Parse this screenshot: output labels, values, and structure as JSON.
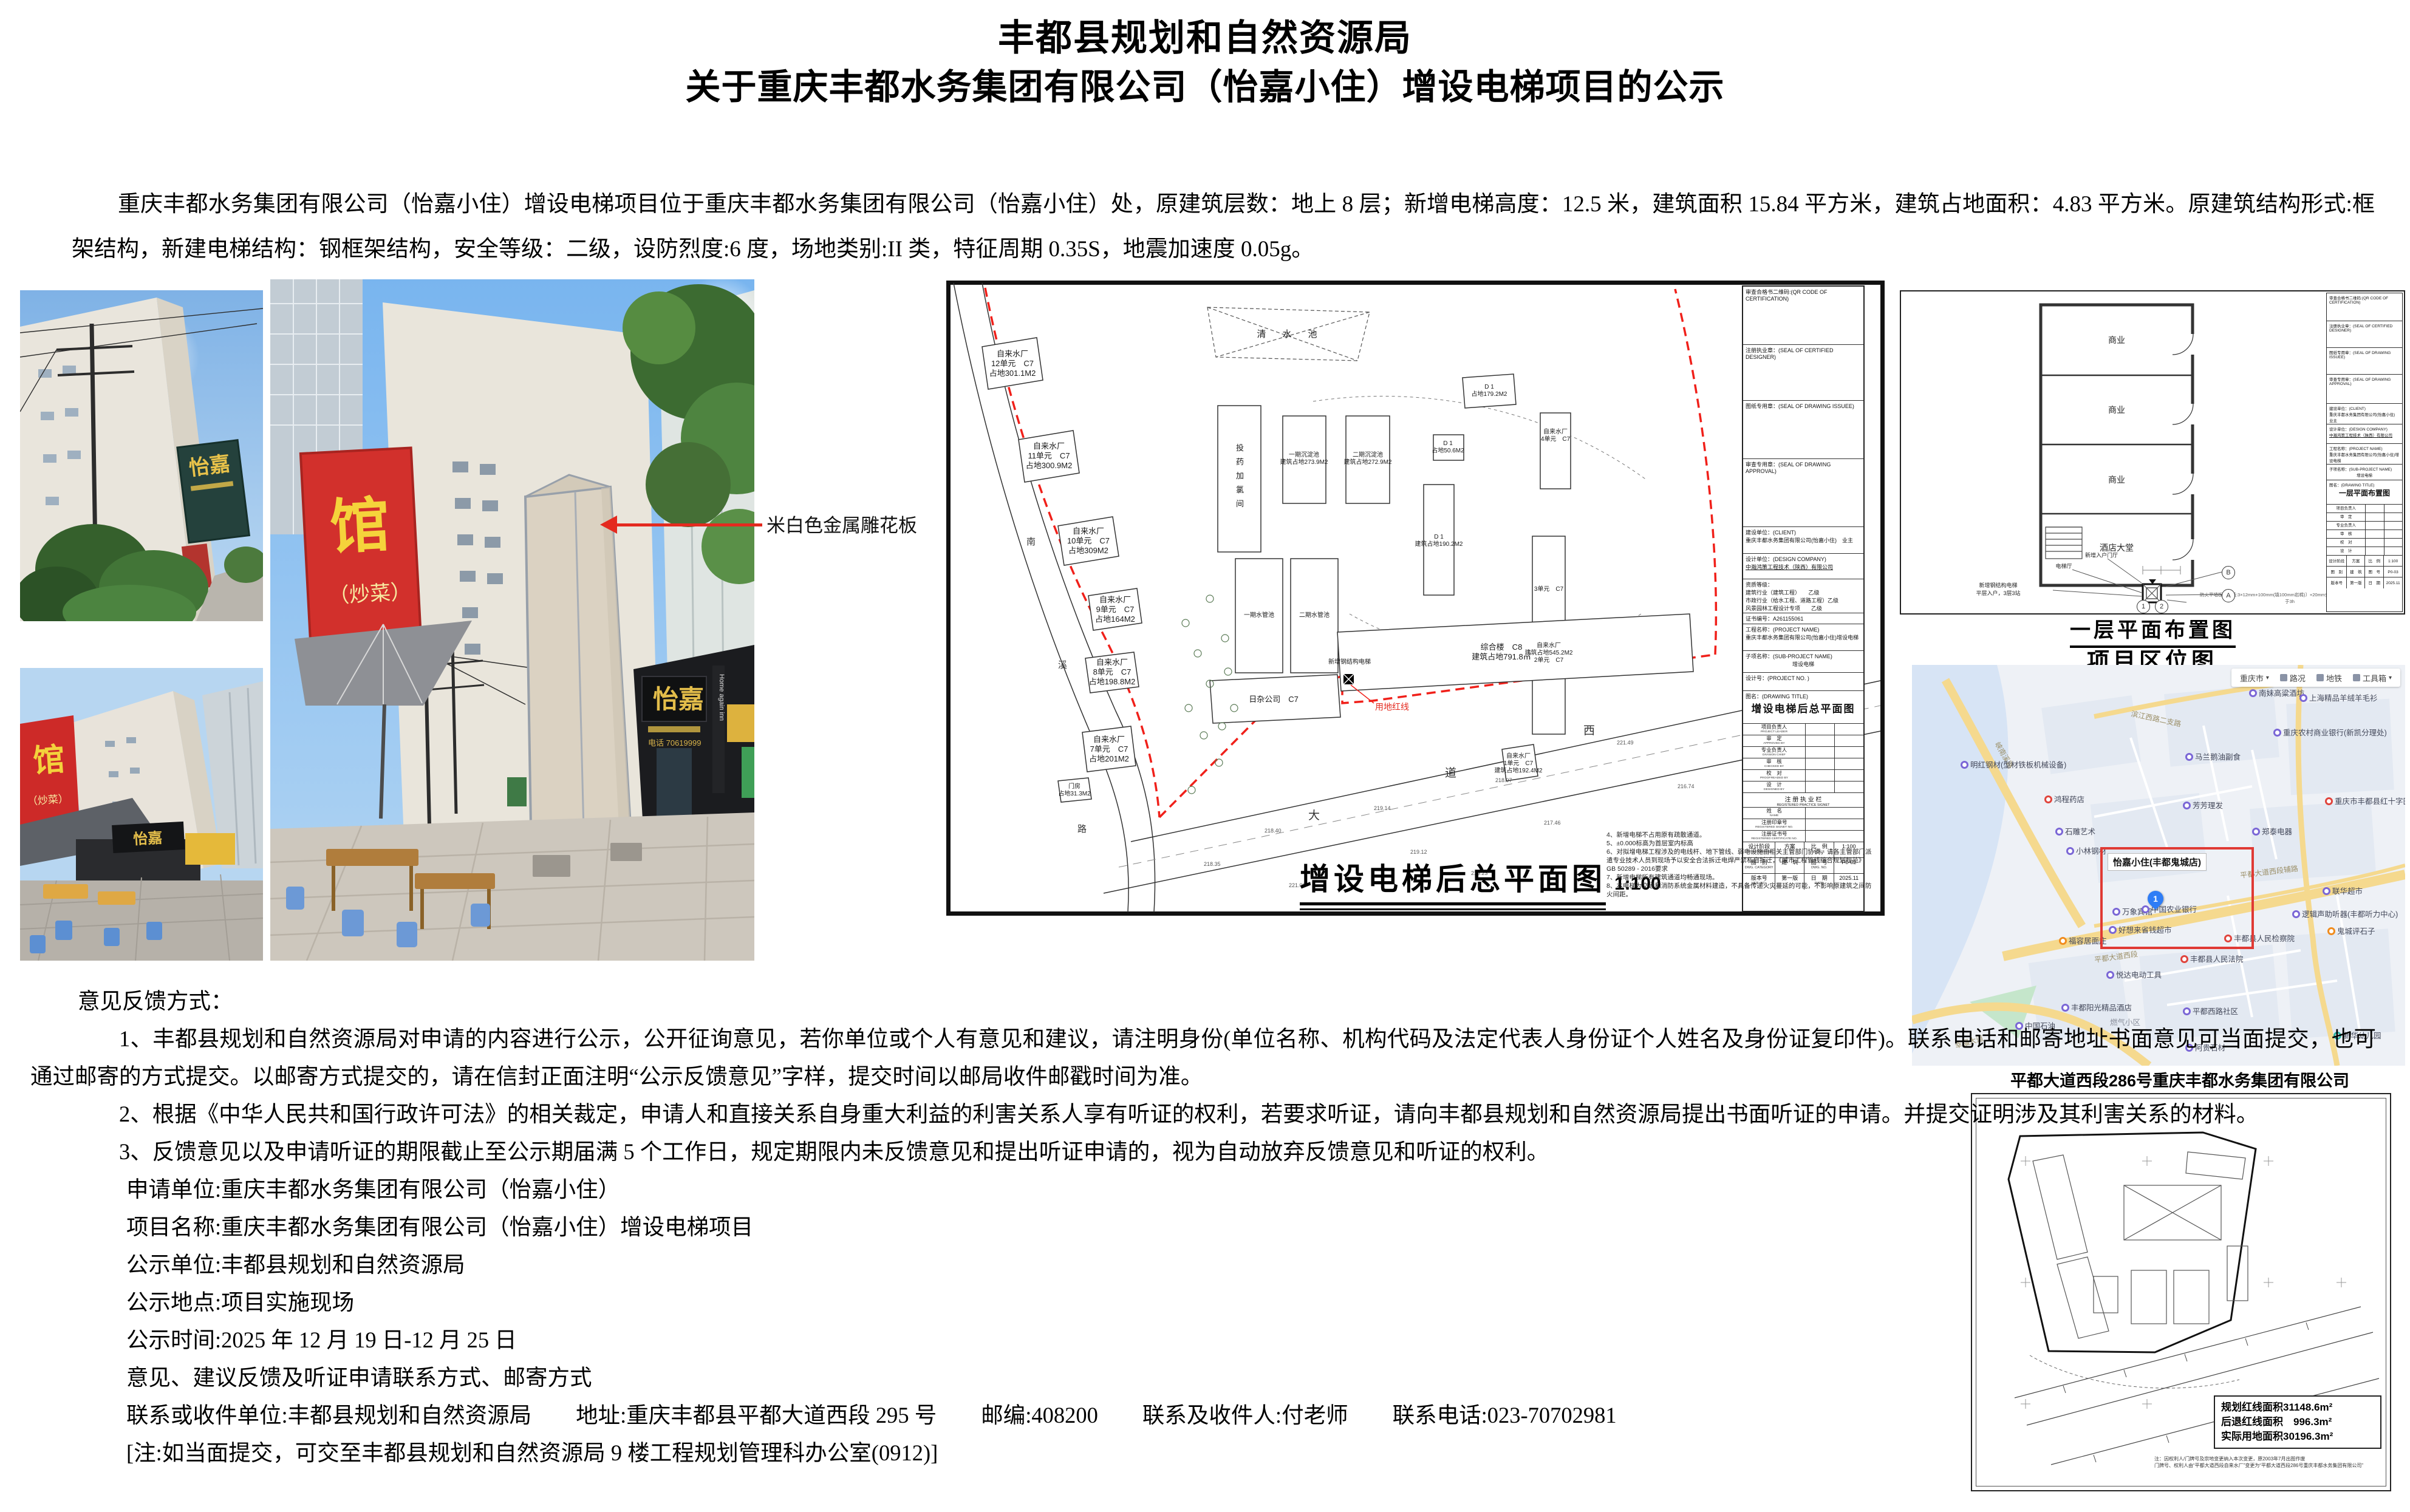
{
  "header": {
    "title": "丰都县规划和自然资源局",
    "subtitle": "关于重庆丰都水务集团有限公司（怡嘉小住）增设电梯项目的公示"
  },
  "intro": {
    "text": "重庆丰都水务集团有限公司（怡嘉小住）增设电梯项目位于重庆丰都水务集团有限公司（怡嘉小住）处，原建筑层数：地上 8 层；新增电梯高度：12.5 米，建筑面积 15.84 平方米，建筑占地面积：4.83 平方米。原建筑结构形式:框架结构，新建电梯结构：钢框架结构，安全等级：二级，设防烈度:6 度，场地类别:II 类，特征周期 0.35S，地震加速度 0.05g。"
  },
  "annotation": {
    "label": "米白色金属雕花板"
  },
  "photos": {
    "sign_yijia": "怡嘉",
    "sign_phone": "电话 70619999",
    "sign_home": "Home again inn",
    "banner_hall": "馆",
    "banner_dish": "（炒菜）"
  },
  "master_plan": {
    "caption": "增设电梯后总平面图",
    "scale": "1:100",
    "red_line_label": "用地红线",
    "elevator_label": "新增钢结构电梯",
    "road_chars": [
      "大",
      "道",
      "西"
    ],
    "river_chars": [
      "南",
      "溪",
      "路"
    ],
    "spot_elevations": [
      "218.40",
      "219.14",
      "218.97",
      "221.49",
      "218.35",
      "219.12",
      "217.46",
      "216.74",
      "221.06",
      "219.23"
    ],
    "notes": [
      "4、新增电梯不占用原有疏散通道。",
      "5、±0.000标高为首层室内标高",
      "6、对拟增电梯工程涉及的电线杆、地下管线、弱电设施由相关主管部门协调，请各主管部门派遣专业技术人员到现场予以安全合法拆迁电焊严禁私自拆迁，《城市工程管线综合规划规范》GB 50289 - 2016要求",
      "7、新增电梯所有建筑通道均畅通现场。",
      "8、本电梯为交通和消防系统金属材料建造，不具备传递火灾蔓延的可能，不影响原建筑之间防火间距。"
    ],
    "labels": {
      "csc": "清　水　池",
      "tyjlj": "投药加氯间",
      "cdc1": [
        "一期沉淀池",
        "建筑占地273.9M2"
      ],
      "cdc2": [
        "二期沉淀池",
        "建筑占地272.9M2"
      ],
      "sgc1": "一期水管池",
      "sgc2": "二期水管池",
      "u12": [
        "自来水厂",
        "12单元　C7",
        "占地301.1M2"
      ],
      "u11": [
        "自来水厂",
        "11单元　C7",
        "占地300.9M2"
      ],
      "u10": [
        "自来水厂",
        "10单元　C7",
        "占地309M2"
      ],
      "u9": [
        "自来水厂",
        "9单元　C7",
        "占地164M2"
      ],
      "u8": [
        "自来水厂",
        "8单元　C7",
        "占地198.8M2"
      ],
      "u7": [
        "自来水厂",
        "7单元　C7",
        "占地201M2"
      ],
      "mf": [
        "门房",
        "占地31.3M2"
      ],
      "d1a": [
        "D 1",
        "占地179.2M2"
      ],
      "d1b": [
        "D 1",
        "占地50.6M2"
      ],
      "d1c": [
        "D 1",
        "建筑占地190.2M2"
      ],
      "u4": [
        "自来水厂",
        "4单元　C7"
      ],
      "u3": [
        "3单元　C7"
      ],
      "u2": [
        "自来水厂",
        "建筑占地545.2M2",
        "2单元　C7"
      ],
      "u1": [
        "自来水厂",
        "1单元　C7",
        "建筑占地192.4M2"
      ],
      "zhl": [
        "综合楼　C8",
        "建筑占地791.8㎡"
      ],
      "rz": [
        "日杂公司　C7"
      ]
    },
    "title_block": {
      "qr": "审查合格书二维码:(QR CODE OF CERTIFICATION)",
      "seal1": "注册执业章：(SEAL OF CERTIFIED DESIGNER)",
      "seal2": "图纸专用章：(SEAL OF DRAWING ISSUEE)",
      "seal3": "审查专用章：(SEAL OF DRAWING APPROVAL)",
      "client_label": "建设单位：(CLIENT)",
      "client": "重庆丰都水务集团有限公司(怡嘉小住)　业主",
      "designer_label": "设计单位：(DESIGN COMPANY)",
      "designer": "中瀚鸿策工程技术（陕西）有限公司",
      "quals_label": "资质等级：",
      "qual1": "建筑行业（建筑工程）　　乙级",
      "qual2": "市政行业（给水工程、道路工程）乙级",
      "qual3": "风景园林工程设计专项　　乙级",
      "cert_no": "证书编号：A261155061",
      "project_label": "工程名称：(PROJECT NAME)",
      "project": "重庆丰都水务集团有限公司(怡嘉小住)增设电梯",
      "sub_label": "子项名称：(SUB-PROJECT NAME)",
      "sub": "增设电梯",
      "design_no_label": "设计号：(PROJECT NO. )",
      "dwg_title_label": "图名：(DRAWING TITLE)",
      "dwg_title": "增设电梯后总平面图",
      "sig_rows": [
        [
          "项目负责人",
          "PROJECT LEADER"
        ],
        [
          "审　定",
          "APPROVED BY"
        ],
        [
          "专业负责人",
          "DIVISION CHIEF"
        ],
        [
          "审　核",
          "CHECKED BY"
        ],
        [
          "校　对",
          "PROOFREADED BY"
        ],
        [
          "设　计",
          "DESIGNED BY"
        ]
      ],
      "practice_bar": "注 册 执 业 栏",
      "practice_bar_en": "REGISTERED PRACTICE SIGNET",
      "name_rows": [
        [
          "姓　名",
          "NAME"
        ],
        [
          "注册印章号",
          "REGISTERED SIGNET NO."
        ],
        [
          "注册证书号",
          "REGISTERED CERTIFICATE NO."
        ]
      ],
      "grid": [
        [
          "设计阶段",
          "方案",
          "比　例",
          "1:100"
        ],
        [
          "图　别",
          "建　筑",
          "图　号",
          "P0-02"
        ],
        [
          "版本号",
          "第一版",
          "日　期",
          "2025.11"
        ]
      ],
      "grid_en": [
        "DESIGN PHASE",
        "SCALE",
        "DWG. CATEGORY",
        "DWG. NO.",
        "VER. NO.",
        "DATE"
      ]
    }
  },
  "floor_plan": {
    "rooms": [
      "商业",
      "商业",
      "商业",
      "酒店大堂"
    ],
    "lobby_label": "新增入户门厅",
    "hall_label": "电梯厅",
    "elevator_label": "新增钢结构电梯",
    "elevator_label2": "平层入户，3层3站",
    "fire_note": "防火平墙板〔构造:3×12mm+100mm(填100mm岩棉)〕+20mm金属雕花板，耐火极限不低于3h",
    "caption1": "一层平面布置图",
    "caption2": "项目区位图",
    "tb": {
      "dwg_title": "一层平面布置图",
      "phase": "方案",
      "scale": "1:100",
      "cat": "建　筑",
      "dwg_no": "P0-03",
      "ver": "第一版",
      "date": "2025.11"
    }
  },
  "map": {
    "controls": [
      "重庆市",
      "路况",
      "地铁",
      "工具箱"
    ],
    "highlight": {
      "name": "怡嘉小住(丰都鬼城店)",
      "marker": "1"
    },
    "roads": [
      "平都大道西段",
      "平都大道西段辅路",
      "幸福大道",
      "滨江西路二支路",
      "峡南溪路"
    ],
    "pois": [
      {
        "name": "南妹高粱酒坊",
        "type": "purple"
      },
      {
        "name": "上海精品羊绒羊毛衫",
        "type": "purple"
      },
      {
        "name": "重庆农村商业银行(新凯分理处)",
        "type": "purple"
      },
      {
        "name": "马兰鹅油副食",
        "type": "purple"
      },
      {
        "name": "明红钢材(型材铁板机械设备)",
        "type": "purple"
      },
      {
        "name": "鸿程药店",
        "type": "red"
      },
      {
        "name": "芳芳理发",
        "type": "purple"
      },
      {
        "name": "郑泰电器",
        "type": "purple"
      },
      {
        "name": "石雕艺术",
        "type": "purple"
      },
      {
        "name": "重庆市丰都县红十字医院",
        "type": "red"
      },
      {
        "name": "小林钢材",
        "type": "purple"
      },
      {
        "name": "联华超市",
        "type": "purple"
      },
      {
        "name": "逻辑声助听器(丰都听力中心)",
        "type": "purple"
      },
      {
        "name": "鬼城评石子",
        "type": "orange"
      },
      {
        "name": "万象宾馆",
        "type": "purple"
      },
      {
        "name": "中国农业银行",
        "type": "purple"
      },
      {
        "name": "好想来省钱超市",
        "type": "purple"
      },
      {
        "name": "福容居面庄",
        "type": "orange"
      },
      {
        "name": "丰都县人民检察院",
        "type": "red"
      },
      {
        "name": "丰都县人民法院",
        "type": "red"
      },
      {
        "name": "悦达电动工具",
        "type": "purple"
      },
      {
        "name": "平都西路社区",
        "type": "purple"
      },
      {
        "name": "燃气小区",
        "type": "plain"
      },
      {
        "name": "丰都阳光精品酒店",
        "type": "purple"
      },
      {
        "name": "中国石油",
        "type": "purple"
      },
      {
        "name": "阿贵石材",
        "type": "purple"
      },
      {
        "name": "新华幼儿园",
        "type": "teal"
      }
    ]
  },
  "survey": {
    "title": "平都大道西段286号重庆丰都水务集团有限公司",
    "legend": [
      "规划红线面积31148.6m²",
      "后退红线面积　996.3m²",
      "实际用地面积30196.3m²"
    ],
    "notes": [
      "注：因权利人/门牌号及宗地变更纳入本次变更，原2003年7月出图作废",
      "门牌号、权利人由“平都大道西段自来水厂”变更为“平都大道西段286号重庆丰都水务集团有限公司”"
    ]
  },
  "feedback": {
    "heading": "意见反馈方式：",
    "item1": "1、丰都县规划和自然资源局对申请的内容进行公示，公开征询意见，若你单位或个人有意见和建议，请注明身份(单位名称、机构代码及法定代表人身份证个人姓名及身份证复印件)。联系电话和邮寄地址书面意见可当面提交，也可通过邮寄的方式提交。以邮寄方式提交的，请在信封正面注明“公示反馈意见”字样，提交时间以邮局收件邮戳时间为准。",
    "item2": "2、根据《中华人民共和国行政许可法》的相关裁定，申请人和直接关系自身重大利益的利害关系人享有听证的权利，若要求听证，请向丰都县规划和自然资源局提出书面听证的申请。并提交证明涉及其利害关系的材料。",
    "item3": "3、反馈意见以及申请听证的期限截止至公示期届满 5 个工作日，规定期限内未反馈意见和提出听证申请的，视为自动放弃反馈意见和听证的权利。",
    "f1": "申请单位:重庆丰都水务集团有限公司（怡嘉小住）",
    "f2": "项目名称:重庆丰都水务集团有限公司（怡嘉小住）增设电梯项目",
    "f3": "公示单位:丰都县规划和自然资源局",
    "f4": "公示地点:项目实施现场",
    "f5": "公示时间:2025 年 12 月 19 日-12 月 25 日",
    "contact_heading": "意见、建议反馈及听证申请联系方式、邮寄方式",
    "contact": "联系或收件单位:丰都县规划和自然资源局　　地址:重庆丰都县平都大道西段 295 号　　邮编:408200　　联系及收件人:付老师　　联系电话:023-70702981",
    "note": "[注:如当面提交，可交至丰都县规划和自然资源局 9 楼工程规划管理科办公室(0912)]"
  }
}
